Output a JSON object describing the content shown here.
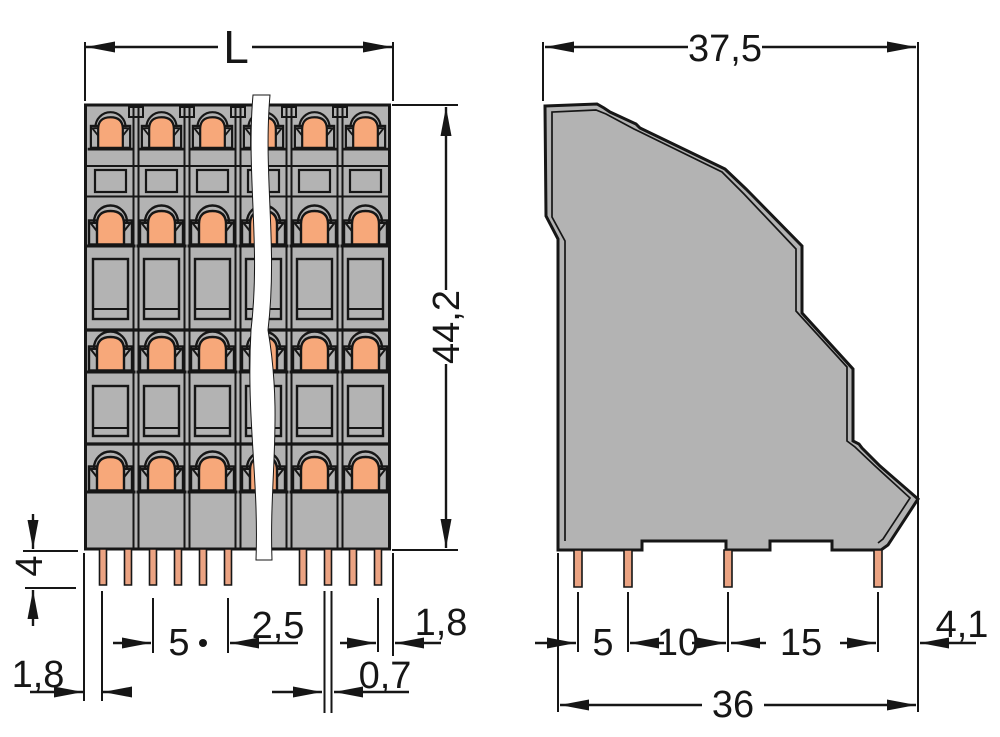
{
  "front_view": {
    "length_label": "L",
    "height": "44,2",
    "pin_length": "4",
    "pin_edge_offset": "1,8",
    "pin_pitch": "5",
    "pin_row_spacing": "2,5",
    "pin_width": "0,7",
    "right_pin_edge_offset": "1,8"
  },
  "side_view": {
    "overall_depth": "37,5",
    "pin_spacing_a": "5",
    "pin_spacing_b": "10",
    "pin_spacing_c": "15",
    "rear_offset": "4,1",
    "body_depth": "36"
  },
  "colors": {
    "background": "#ffffff",
    "body": "#b3b3b3",
    "actuator": "#f7a87a",
    "pin": "#eba382",
    "line": "#161616"
  }
}
